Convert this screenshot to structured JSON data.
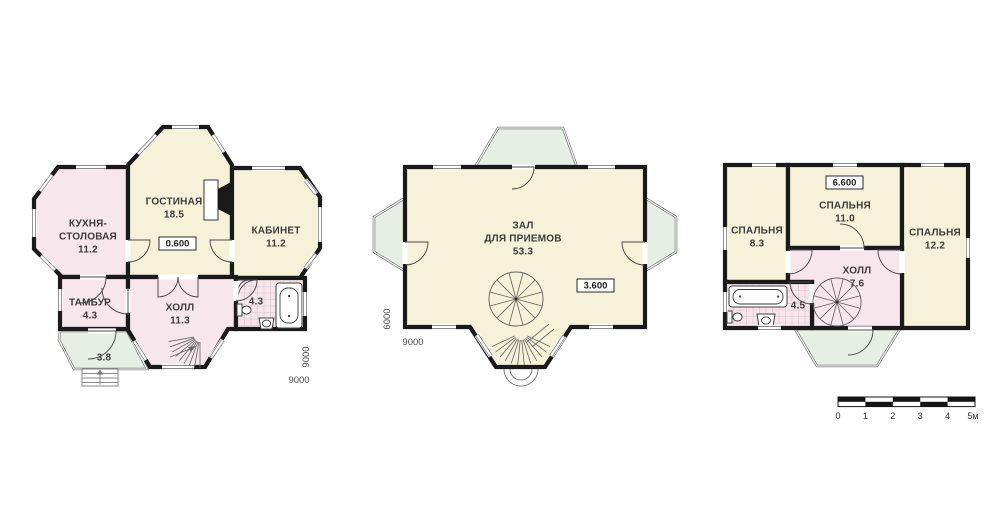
{
  "colors": {
    "cream": "#f5f2d9",
    "pink": "#f8e6ed",
    "green": "#e5efe3",
    "wall": "#1a1a1a"
  },
  "floor1": {
    "kitchen": {
      "l1": "КУХНЯ-",
      "l2": "СТОЛОВАЯ",
      "area": "11.2"
    },
    "living": {
      "l1": "ГОСТИНАЯ",
      "area": "18.5"
    },
    "study": {
      "l1": "КАБИНЕТ",
      "area": "11.2"
    },
    "tambour": {
      "l1": "ТАМБУР",
      "area": "4.3"
    },
    "hall": {
      "l1": "ХОЛЛ",
      "area": "11.3"
    },
    "bath": {
      "area": "4.3"
    },
    "porch": {
      "area": "3.8"
    },
    "elevation": "0.600",
    "dim_width": "9000",
    "dim_depth": "9000"
  },
  "floor2": {
    "hall": {
      "l1": "ЗАЛ",
      "l2": "ДЛЯ ПРИЕМОВ",
      "area": "53.3"
    },
    "elevation": "3.600",
    "dim_width": "9000",
    "dim_depth": "6000"
  },
  "floor3": {
    "bedroom1": {
      "l1": "СПАЛЬНЯ",
      "area": "8.3"
    },
    "bedroom2": {
      "l1": "СПАЛЬНЯ",
      "area": "11.0"
    },
    "bedroom3": {
      "l1": "СПАЛЬНЯ",
      "area": "12.2"
    },
    "hall": {
      "l1": "ХОЛЛ",
      "area": "7.6"
    },
    "bath": {
      "area": "4.5"
    },
    "elevation": "6.600"
  },
  "scale_bar": {
    "labels": [
      "0",
      "1",
      "2",
      "3",
      "4",
      "5м"
    ]
  }
}
